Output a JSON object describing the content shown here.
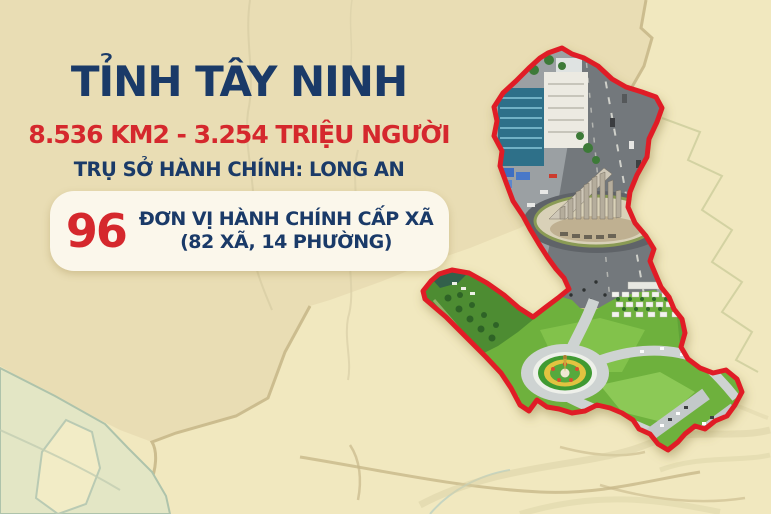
{
  "infographic": {
    "title": "TỈNH TÂY NINH",
    "area_population": "8.536 KM2 - 3.254 TRIỆU NGƯỜI",
    "admin_center": "TRỤ SỞ HÀNH CHÍNH: LONG AN",
    "admin_units": {
      "count": "96",
      "label_line1": "ĐƠN VỊ HÀNH CHÍNH CẤP XÃ",
      "label_line2": "(82 XÃ, 14 PHƯỜNG)"
    }
  },
  "map": {
    "province_border_color": "#e01f25",
    "photo_areas": [
      {
        "name": "city-monument-roundabout-photo"
      },
      {
        "name": "green-landscape-roundabout-photo"
      }
    ]
  },
  "colors": {
    "background": "#f1e8bf",
    "background_dark_region": "#e9ddb4",
    "background_green_region": "#e3e6c5",
    "title_navy": "#1a3a68",
    "accent_red": "#d5282d",
    "info_box_bg": "#fbf7eb"
  }
}
